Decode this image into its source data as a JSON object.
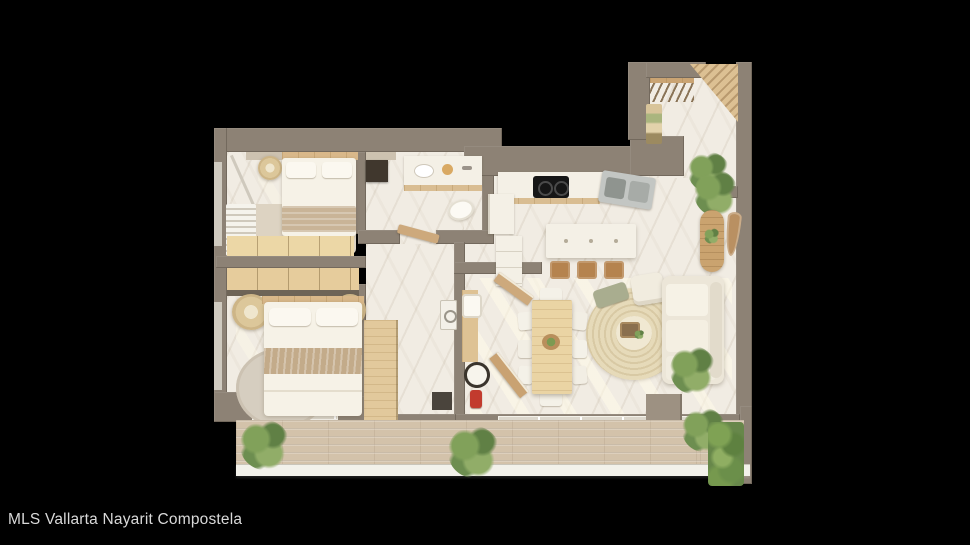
{
  "caption": {
    "text": "MLS Vallarta Nayarit Compostela"
  },
  "scene": {
    "type": "3d-rendered-floor-plan-top-view",
    "description": "Top-down 3D render of a two-bedroom, two-bathroom apartment with kitchen island, dining table, living area and a plant-lined wooden balcony, on a black background",
    "background_color": "#000000"
  },
  "palette": {
    "wall": "#8d8275",
    "floor_marble": "#f1ece3",
    "wood_light": "#e6cc9c",
    "wood_mid": "#cda97c",
    "wood_stool": "#b5834e",
    "deck": "#d3c2aa",
    "linen": "#f6f2e7",
    "blanket": "#c6af90",
    "rug": "#e2d5b4",
    "plant_green": "#76994e",
    "cooktop_black": "#161616",
    "towel_red": "#c23b2e",
    "railing_white": "#f2f1ea"
  },
  "rooms": [
    {
      "name": "bedroom-1",
      "furniture": [
        "double bed",
        "round side table",
        "area rug",
        "louvered closet",
        "built-in wardrobe"
      ]
    },
    {
      "name": "bathroom-1",
      "furniture": [
        "double vanity",
        "toilet",
        "wall mirror",
        "open door"
      ]
    },
    {
      "name": "entry-hall",
      "furniture": [
        "coat rack with hangers",
        "shelving",
        "slatted wood bench",
        "plant"
      ]
    },
    {
      "name": "kitchen",
      "furniture": [
        "cooktop counter",
        "stainless sink",
        "fridge",
        "island with three stools"
      ]
    },
    {
      "name": "dining-area",
      "furniture": [
        "wood dining table",
        "eight white chairs",
        "centerpiece"
      ]
    },
    {
      "name": "living-area",
      "furniture": [
        "round jute rug",
        "coffee tray",
        "sofa",
        "armchair",
        "console table",
        "leaf mirror",
        "plants"
      ]
    },
    {
      "name": "master-bedroom",
      "furniture": [
        "double bed",
        "two rattan poufs",
        "round rug",
        "wardrobe",
        "sliding glass door"
      ]
    },
    {
      "name": "bathroom-2",
      "furniture": [
        "wood vanity with sink",
        "toilet",
        "red towel",
        "washer",
        "angled doors"
      ]
    },
    {
      "name": "balcony",
      "furniture": [
        "wood deck",
        "planters",
        "green hedge",
        "white railing"
      ]
    }
  ]
}
